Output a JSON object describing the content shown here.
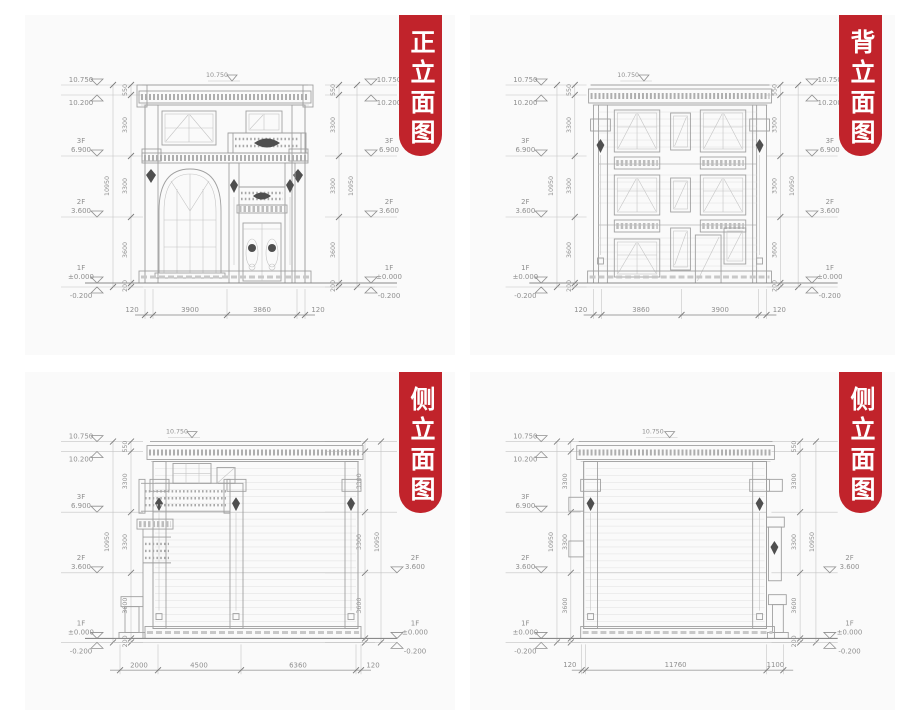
{
  "colors": {
    "banner_red": "#c1232b",
    "banner_text": "#ffffff",
    "panel_bg": "#fafafa",
    "line_gray": "#a0a0a0",
    "dim_text": "#8f8f8f"
  },
  "levels": {
    "top": "10.750",
    "parapet": "10.200",
    "f3": "3F",
    "f3v": "6.900",
    "f2": "2F",
    "f2v": "3.600",
    "f1": "1F",
    "f1v": "±0.000",
    "below": "-0.200"
  },
  "chain": {
    "total": "10950",
    "s0": "550",
    "s1": "3300",
    "s2": "3300",
    "s3": "3600",
    "s4": "200"
  },
  "panels": {
    "front": {
      "title": "正立面图",
      "dims": [
        "120",
        "3900",
        "3860",
        "120"
      ]
    },
    "back": {
      "title": "背立面图",
      "dims": [
        "120",
        "3860",
        "3900",
        "120"
      ]
    },
    "side1": {
      "title": "侧立面图",
      "dims": [
        "2000",
        "4500",
        "6360",
        "120"
      ]
    },
    "side2": {
      "title": "侧立面图",
      "dims": [
        "120",
        "11760",
        "1100"
      ]
    }
  }
}
